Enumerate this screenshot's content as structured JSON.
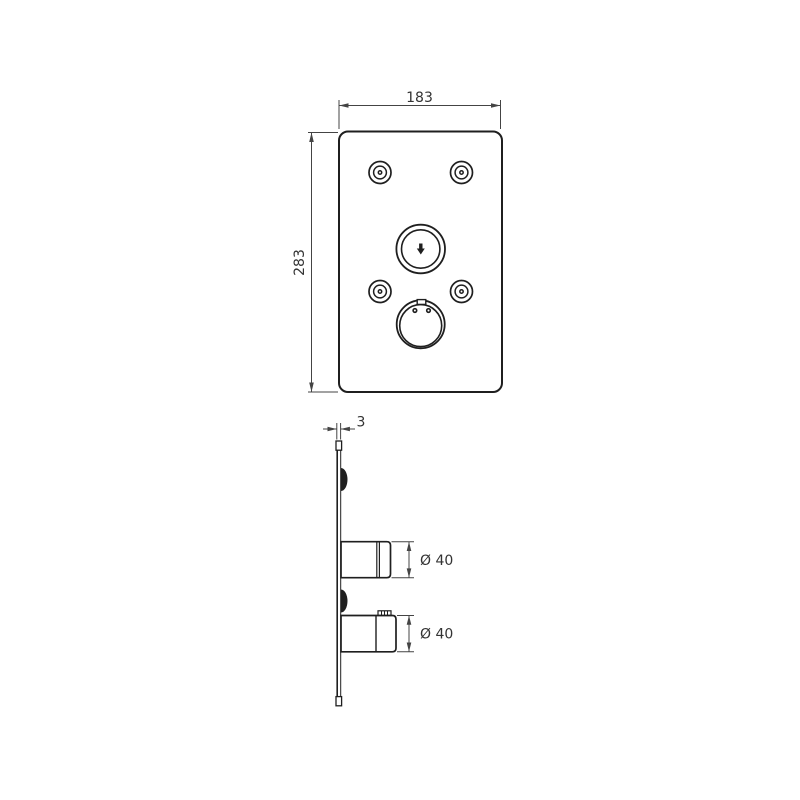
{
  "drawing": {
    "title": "concealed-thermostat-faceplate-dimension-drawing",
    "front_view": {
      "width_label": "183",
      "height_label": "283"
    },
    "side_view": {
      "thickness_label": "3",
      "upper_knob_diameter_label": "Ø 40",
      "lower_knob_diameter_label": "Ø 40"
    },
    "colors": {
      "line": "#1f1f1f",
      "dimension": "#444444",
      "text": "#333333",
      "background": "#ffffff"
    }
  }
}
